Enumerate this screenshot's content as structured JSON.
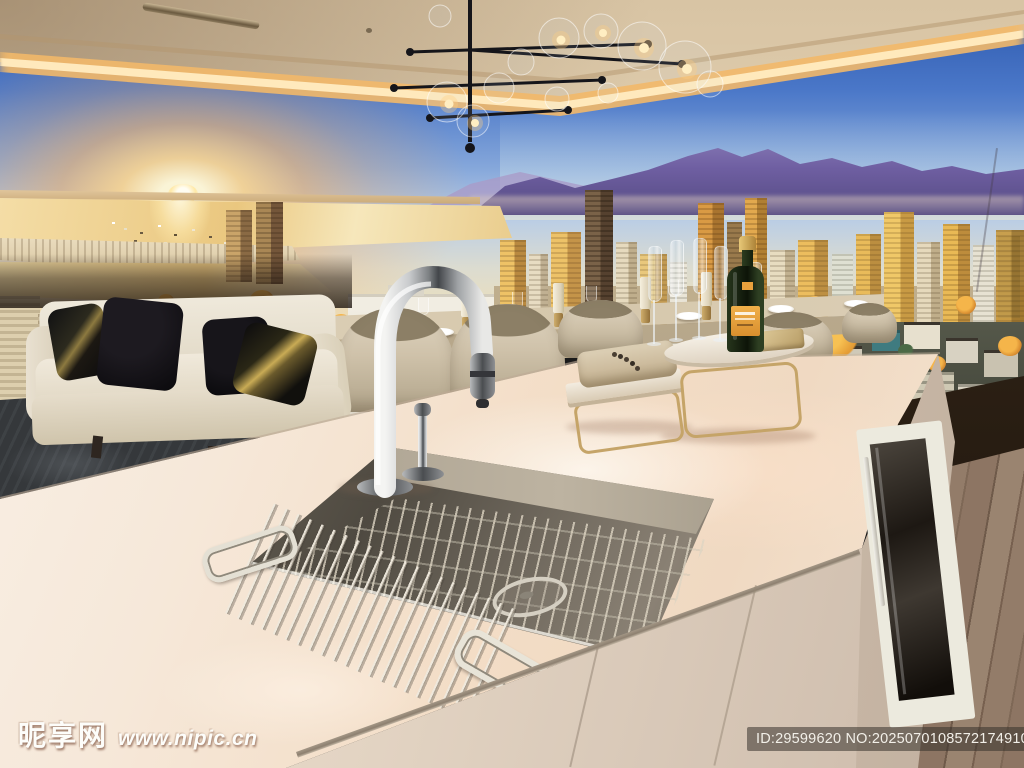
{
  "scene": {
    "type": "photograph",
    "description": "Luxury show-suite kitchen: white island with stainless sink and chrome gooseneck faucet, cream sofa with black pillows, travertine dining bar with candles and place settings, champagne bottle and flutes on brass stands, panoramic sunset city-and-mountain mural, cove-lit ceiling with glass-bubble chandelier, hardwood floor"
  },
  "watermarks": {
    "site_logo": "昵享网",
    "site_url": "www.nipic.cn",
    "image_id": "ID:29599620 NO:20250701085721749105"
  },
  "palette": {
    "sky_top": "#2b57ac",
    "sky_mid": "#84a6da",
    "horizon_glow": "#f9d99b",
    "sun_core": "#fff6d8",
    "mountain": "#6f5fa2",
    "golden_city": "#e8b85c",
    "water": "#ecd08e",
    "ceiling_glow": "#ffd98f",
    "counter_top": "#f6ece1",
    "steel_sink": "#6e675a",
    "wood_floor": "#8a7260",
    "window_ledge": "#2e2218",
    "sofa": "#eae3d5",
    "rug": "#36393c",
    "chair": "#cfc3ae",
    "brass": "#c5a468",
    "champagne_label": "#e8a03c",
    "watermark_bar": "rgba(55,50,44,0.55)"
  }
}
